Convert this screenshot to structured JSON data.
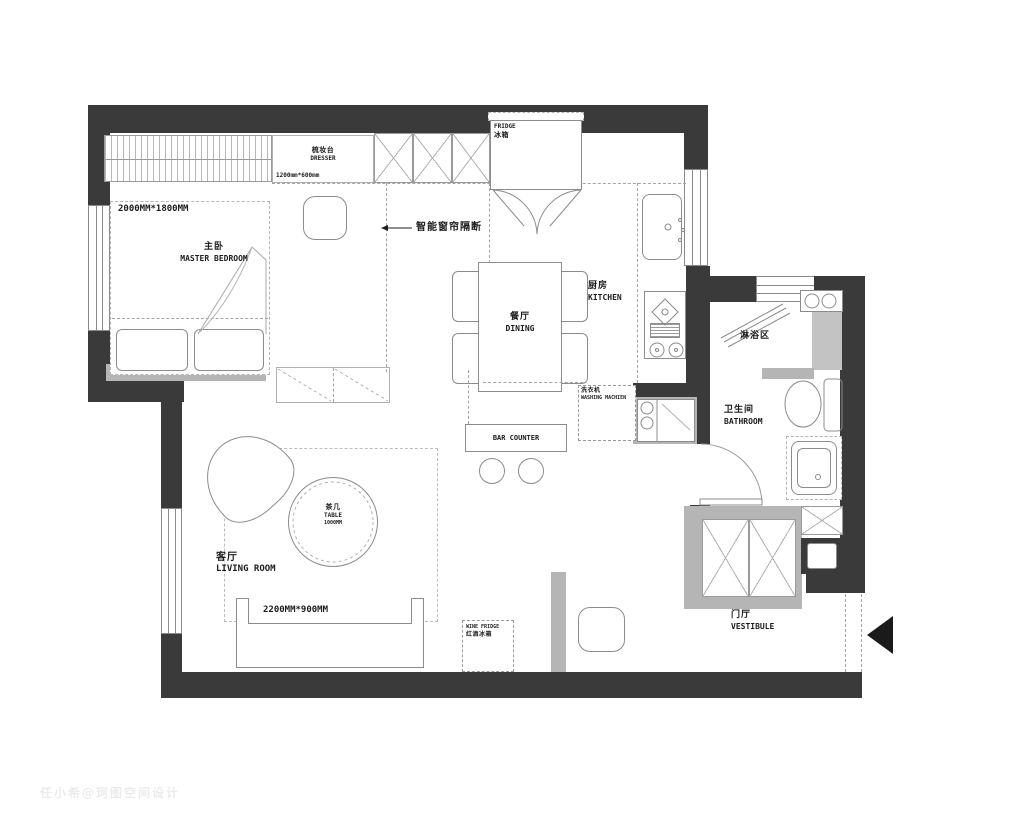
{
  "labels": {
    "bedroom_dim": "2000MM*1800MM",
    "bedroom_cn": "主卧",
    "bedroom_en": "MASTER BEDROOM",
    "dresser_cn": "梳妆台",
    "dresser_en": "DRESSER",
    "dresser_dim": "1200mm*600mm",
    "fridge_en": "FRIDGE",
    "fridge_cn": "冰箱",
    "curtain": "智能窗帘隔断",
    "dining_cn": "餐厅",
    "dining_en": "DINING",
    "kitchen_cn": "厨房",
    "kitchen_en": "KITCHEN",
    "shower_cn": "淋浴区",
    "bathroom_cn": "卫生间",
    "bathroom_en": "BATHROOM",
    "washing_cn": "洗衣机",
    "washing_en": "WASHING MACHIEN",
    "bar_counter": "BAR COUNTER",
    "table_cn": "茶几",
    "table_en": "TABLE",
    "table_dim": "1000MM",
    "living_cn": "客厅",
    "living_en": "LIVING ROOM",
    "sofa_dim": "2200MM*900MM",
    "wine_en": "WINE FRIDGE",
    "wine_cn": "红酒冰箱",
    "vestibule_cn": "门厅",
    "vestibule_en": "VESTIBULE"
  },
  "colors": {
    "wall": "#3a3a3a",
    "partition_gray": "#b5b5b5",
    "line": "#8c8c8c",
    "background": "#ffffff"
  },
  "watermark": "任小希@珂图空间设计"
}
